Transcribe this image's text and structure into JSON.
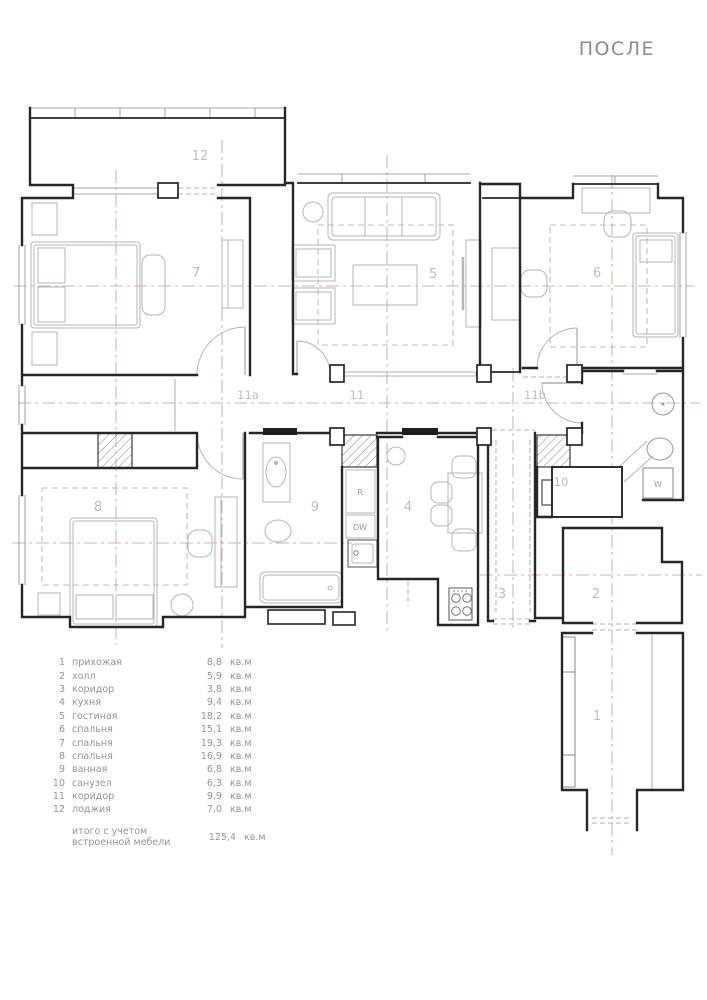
{
  "title": "ПОСЛЕ",
  "room_labels": {
    "r1": "1",
    "r2": "2",
    "r3": "3",
    "r4": "4",
    "r5": "5",
    "r6": "6",
    "r7": "7",
    "r8": "8",
    "r9": "9",
    "r10": "10",
    "r11": "11",
    "r11a": "11a",
    "r11b": "11b",
    "r12": "12"
  },
  "appliance_labels": {
    "fridge": "R",
    "dishwasher": "DW",
    "washer": "W"
  },
  "legend": {
    "items": [
      {
        "num": "1",
        "name": "прихожая",
        "area": "8,8",
        "unit": "кв.м"
      },
      {
        "num": "2",
        "name": "холл",
        "area": "5,9",
        "unit": "кв.м"
      },
      {
        "num": "3",
        "name": "коридор",
        "area": "3,8",
        "unit": "кв.м"
      },
      {
        "num": "4",
        "name": "кухня",
        "area": "9,4",
        "unit": "кв.м"
      },
      {
        "num": "5",
        "name": "гостиная",
        "area": "18,2",
        "unit": "кв.м"
      },
      {
        "num": "6",
        "name": "спальня",
        "area": "15,1",
        "unit": "кв.м"
      },
      {
        "num": "7",
        "name": "спальня",
        "area": "19,3",
        "unit": "кв.м"
      },
      {
        "num": "8",
        "name": "спальня",
        "area": "16,9",
        "unit": "кв.м"
      },
      {
        "num": "9",
        "name": "ванная",
        "area": "6,8",
        "unit": "кв.м"
      },
      {
        "num": "10",
        "name": "санузел",
        "area": "6,3",
        "unit": "кв.м"
      },
      {
        "num": "11",
        "name": "коридор",
        "area": "9,9",
        "unit": "кв.м"
      },
      {
        "num": "12",
        "name": "лоджия",
        "area": "7,0",
        "unit": "кв.м"
      }
    ],
    "total": {
      "label": "итого с учетом встроенной мебели",
      "area": "125,4",
      "unit": "кв.м"
    }
  },
  "colors": {
    "wall": "#262626",
    "furniture": "#b6b6b6",
    "axis": "#c49a9a",
    "room_label": "#bdbdbd",
    "legend_text": "#949494",
    "title_text": "#8c8c8c"
  }
}
